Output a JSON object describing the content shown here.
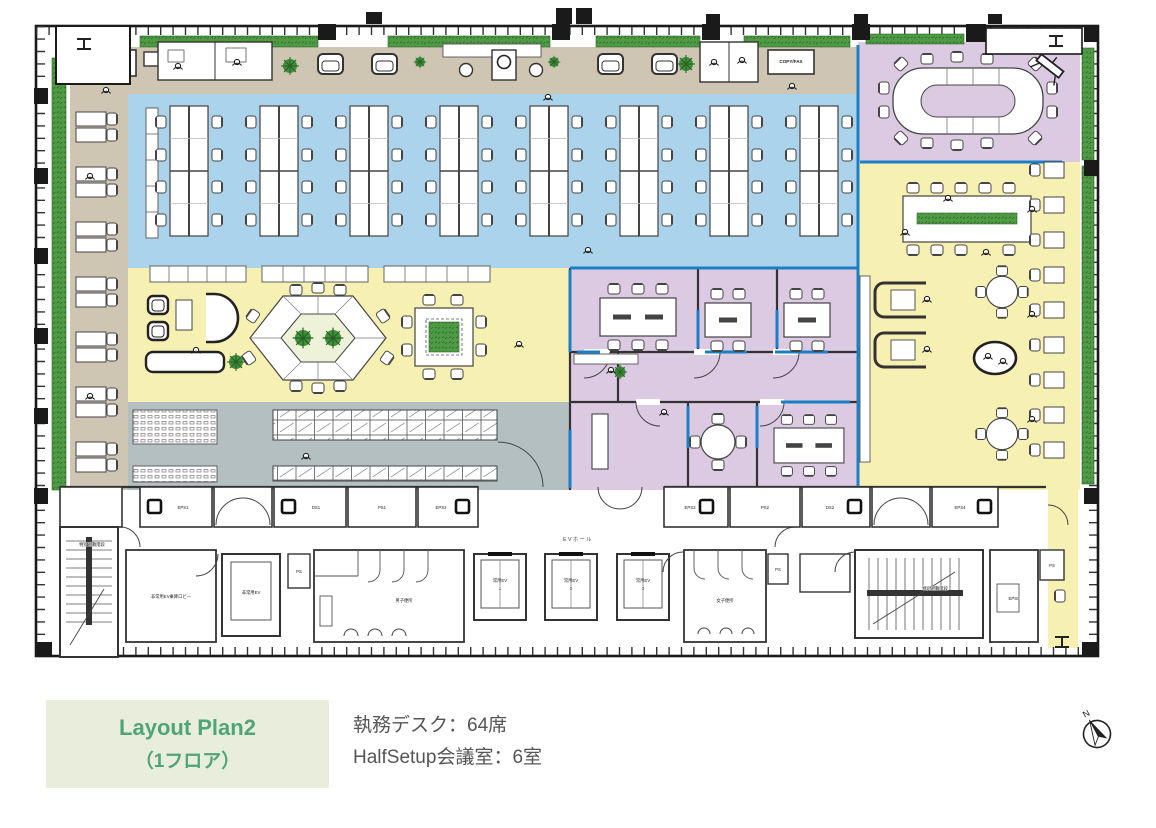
{
  "caption": {
    "title": "Layout Plan2",
    "subtitle": "（1フロア）",
    "stat_desks": "執務デスク：64席",
    "stat_rooms": "HalfSetup会議室：6室"
  },
  "compass": {
    "north_label": "N"
  },
  "plan": {
    "copyfax_left": "COPY/FAX",
    "copyfax_top": "COPY/FAX",
    "ev_hall": "EVホール",
    "shafts": {
      "eps1": "EPS1",
      "ds1": "DS1",
      "ps1": "PS1",
      "eps2": "EPS2",
      "eps3": "EPS3",
      "ps2": "PS2",
      "ds2": "DS2",
      "eps4": "EPS4",
      "eps5": "EPS5",
      "ps_a": "PS",
      "ps_b": "PS",
      "ps_c": "PS"
    },
    "core": {
      "stair_left": "特別避難階段",
      "stair_right": "特別避難階段",
      "ev_lobby": "非常用EV乗降ロビー",
      "emergency_ev": "非常用EV",
      "ev_label": "常用EV",
      "ev1_no": "1",
      "ev2_no": "2",
      "ev3_no": "3",
      "mens_wc": "男子便所",
      "womens_wc": "女子便所"
    }
  },
  "colors": {
    "office_blue": "#abd3ec",
    "collab_yellow": "#f6f0b2",
    "meeting_purple": "#dccae3",
    "locker_gray": "#b3bfc1",
    "lounge_tan": "#cfc5b3",
    "planting_green": "#4f9a44",
    "partition_blue": "#1b7fc4",
    "caption_bg": "#e9eddb",
    "caption_text": "#4fa578",
    "stat_text": "#555555"
  }
}
